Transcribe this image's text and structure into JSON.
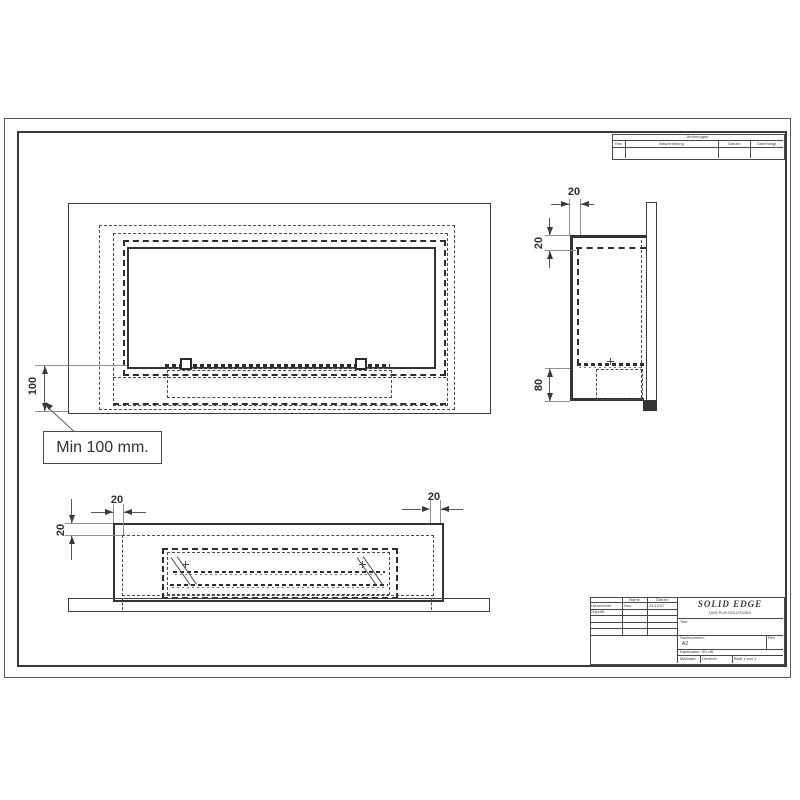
{
  "drawing": {
    "callout_text": "Min 100 mm.",
    "front_view": {
      "dim_height": "100"
    },
    "side_view": {
      "dim_depth": "20",
      "dim_top_inset": "20",
      "dim_burner_depth": "80"
    },
    "bottom_view": {
      "dim_wall_left": "20",
      "dim_wall_right": "20",
      "dim_front_inset": "20"
    }
  },
  "revision_table": {
    "title": "Änderungen",
    "columns": [
      "Rev",
      "Beschreibung",
      "Datum",
      "Genehmigt"
    ]
  },
  "title_block": {
    "logo": "SOLID EDGE",
    "logo_subtitle": "UGS PLM SOLUTIONS",
    "name_header": "Name",
    "date_header": "Datum",
    "rows": [
      {
        "label": "Gezeichnet",
        "name": "Hou",
        "date": "24.10.07"
      },
      {
        "label": "Geprüft",
        "name": "",
        "date": ""
      }
    ],
    "title_label": "Titel",
    "part_number_label": "Sachnummer:",
    "size": "A2",
    "rev_label": "Rev",
    "filename_label": "Dateiname: SO.dft",
    "scale_label": "Maßstab:",
    "weight_label": "Gewicht:",
    "sheet_label": "Blatt 1 von 1"
  }
}
